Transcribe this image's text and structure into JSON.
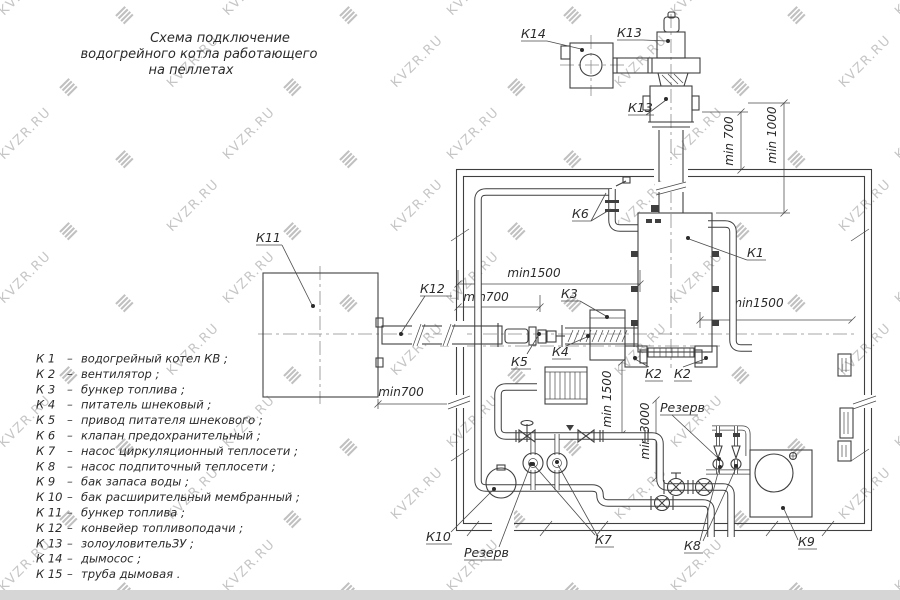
{
  "watermark": {
    "text": "KVZR.RU",
    "color": "#c6c6c6"
  },
  "title": {
    "lines": [
      "Схема подключение",
      "водогрейного котла работающего",
      "на пеллетах"
    ]
  },
  "legend": {
    "dash": "–",
    "items": [
      {
        "k": "К 1",
        "d": "водогрейный котел КВ ;"
      },
      {
        "k": "К 2",
        "d": "вентилятор ;"
      },
      {
        "k": "К 3",
        "d": "бункер топлива ;"
      },
      {
        "k": "К 4",
        "d": "питатель шнековый ;"
      },
      {
        "k": "К 5",
        "d": "привод питателя шнекового ;"
      },
      {
        "k": "К 6",
        "d": "клапан предохранительный ;"
      },
      {
        "k": "К 7",
        "d": "насос циркуляционный теплосети ;"
      },
      {
        "k": "К 8",
        "d": "насос подпиточный теплосети ;"
      },
      {
        "k": "К 9",
        "d": "бак запаса воды ;"
      },
      {
        "k": "К 10",
        "d": "бак расширительный мембранный ;"
      },
      {
        "k": "К 11",
        "d": "бункер топлива ;"
      },
      {
        "k": "К 12",
        "d": "конвейер топливоподачи ;"
      },
      {
        "k": "К 13",
        "d": "золоуловительЗУ ;"
      },
      {
        "k": "К 14",
        "d": "дымосос ;"
      },
      {
        "k": "К 15",
        "d": "труба дымовая ."
      }
    ]
  },
  "diagram": {
    "callouts": [
      {
        "id": "k14",
        "text": "К14",
        "tx": 521,
        "ty": 38,
        "ux2": 547,
        "leaders": [
          [
            547,
            41,
            581,
            49
          ]
        ],
        "dots": [
          [
            582,
            50
          ]
        ]
      },
      {
        "id": "k13-top",
        "text": "К13",
        "tx": 617,
        "ty": 37,
        "ux2": 643,
        "leaders": [
          [
            643,
            40,
            667,
            41
          ]
        ],
        "dots": [
          [
            668,
            41
          ]
        ]
      },
      {
        "id": "k13-mid",
        "text": "К13",
        "tx": 628,
        "ty": 112,
        "ux2": 654,
        "leaders": [
          [
            646,
            115,
            666,
            100
          ]
        ],
        "dots": [
          [
            666,
            99
          ]
        ]
      },
      {
        "id": "k6",
        "text": "К6",
        "tx": 572,
        "ty": 218,
        "ux2": 591,
        "leaders": [
          [
            591,
            221,
            606,
            193
          ],
          [
            591,
            221,
            611,
            209
          ]
        ],
        "dots": []
      },
      {
        "id": "k1",
        "text": "К1",
        "tx": 747,
        "ty": 257,
        "ux2": 766,
        "leaders": [
          [
            747,
            260,
            689,
            239
          ]
        ],
        "dots": [
          [
            688,
            238
          ]
        ]
      },
      {
        "id": "k11",
        "text": "К11",
        "tx": 256,
        "ty": 242,
        "ux2": 282,
        "leaders": [
          [
            282,
            245,
            312,
            305
          ]
        ],
        "dots": [
          [
            313,
            306
          ]
        ]
      },
      {
        "id": "k12",
        "text": "К12",
        "tx": 420,
        "ty": 293,
        "ux2": 452,
        "leaders": [
          [
            425,
            296,
            401,
            333
          ]
        ],
        "dots": [
          [
            401,
            334
          ]
        ]
      },
      {
        "id": "k3",
        "text": "К3",
        "tx": 561,
        "ty": 298,
        "ux2": 580,
        "leaders": [
          [
            580,
            301,
            606,
            316
          ]
        ],
        "dots": [
          [
            607,
            317
          ]
        ]
      },
      {
        "id": "k5",
        "text": "К5",
        "tx": 511,
        "ty": 366,
        "ux2": 531,
        "leaders": [
          [
            527,
            354,
            538,
            336
          ]
        ],
        "dots": [
          [
            539,
            334
          ]
        ]
      },
      {
        "id": "k4",
        "text": "К4",
        "tx": 552,
        "ty": 356,
        "ux2": 571,
        "leaders": [
          [
            566,
            346,
            587,
            337
          ]
        ],
        "dots": [
          [
            588,
            336
          ]
        ]
      },
      {
        "id": "k2-left",
        "text": "К2",
        "tx": 645,
        "ty": 378,
        "ux2": 663,
        "leaders": [
          [
            649,
            367,
            635,
            359
          ]
        ],
        "dots": [
          [
            635,
            358
          ]
        ]
      },
      {
        "id": "k2-right",
        "text": "К2",
        "tx": 674,
        "ty": 378,
        "ux2": 692,
        "leaders": [
          [
            683,
            367,
            705,
            359
          ]
        ],
        "dots": [
          [
            706,
            358
          ]
        ]
      },
      {
        "id": "rezerv-top",
        "text": "Резерв",
        "tx": 660,
        "ty": 412,
        "ux2": 698,
        "leaders": [
          [
            672,
            415,
            718,
            458
          ]
        ],
        "dots": [
          [
            719,
            459
          ]
        ]
      },
      {
        "id": "k10",
        "text": "К10",
        "tx": 426,
        "ty": 541,
        "ux2": 452,
        "leaders": [
          [
            451,
            532,
            493,
            490
          ]
        ],
        "dots": [
          [
            494,
            489
          ]
        ]
      },
      {
        "id": "rezerv-bottom",
        "text": "Резерв",
        "tx": 464,
        "ty": 557,
        "ux2": 502,
        "leaders": [
          [
            499,
            547,
            530,
            466
          ]
        ],
        "dots": [
          [
            531,
            464
          ]
        ]
      },
      {
        "id": "k7",
        "text": "К7",
        "tx": 595,
        "ty": 544,
        "ux2": 614,
        "leaders": [
          [
            595,
            535,
            534,
            465
          ],
          [
            597,
            535,
            558,
            465
          ]
        ],
        "dots": [
          [
            533,
            464
          ],
          [
            557,
            462
          ]
        ]
      },
      {
        "id": "k8",
        "text": "К8",
        "tx": 684,
        "ty": 550,
        "ux2": 703,
        "leaders": [
          [
            700,
            541,
            719,
            469
          ],
          [
            703,
            541,
            736,
            468
          ]
        ],
        "dots": [
          [
            720,
            467
          ],
          [
            736,
            466
          ]
        ]
      },
      {
        "id": "k9",
        "text": "К9",
        "tx": 798,
        "ty": 546,
        "ux2": 817,
        "leaders": [
          [
            798,
            540,
            784,
            509
          ]
        ],
        "dots": [
          [
            783,
            508
          ]
        ]
      }
    ],
    "dimensions": [
      {
        "text": "min1500",
        "tx": 534,
        "ty": 277,
        "rot": 0,
        "lines": [
          [
            458,
            270,
            458,
            300
          ],
          [
            640,
            270,
            640,
            292
          ],
          [
            458,
            284,
            640,
            284
          ]
        ],
        "ticks": [
          [
            458,
            284
          ],
          [
            640,
            284
          ]
        ]
      },
      {
        "text": "min700",
        "tx": 486,
        "ty": 301,
        "rot": 0,
        "lines": [
          [
            540,
            295,
            540,
            312
          ],
          [
            458,
            307,
            540,
            307
          ]
        ],
        "ticks": [
          [
            458,
            307
          ],
          [
            540,
            307
          ]
        ]
      },
      {
        "text": "min1500",
        "tx": 757,
        "ty": 307,
        "rot": 0,
        "lines": [
          [
            700,
            312,
            700,
            328
          ],
          [
            700,
            320,
            852,
            320
          ]
        ],
        "ticks": [
          [
            700,
            320
          ],
          [
            852,
            320
          ]
        ]
      },
      {
        "text": "min700",
        "tx": 401,
        "ty": 396,
        "rot": 0,
        "lines": [
          [
            378,
            399,
            378,
            409
          ],
          [
            378,
            404,
            457,
            404
          ]
        ],
        "ticks": [
          [
            378,
            404
          ],
          [
            457,
            404
          ]
        ]
      },
      {
        "text": "min 700",
        "tx": 733,
        "ty": 141,
        "rot": -90,
        "lines": [
          [
            702,
            112,
            748,
            112
          ],
          [
            741,
            112,
            741,
            170
          ]
        ],
        "ticks": [
          [
            741,
            112
          ],
          [
            741,
            170
          ]
        ]
      },
      {
        "text": "min 1000",
        "tx": 776,
        "ty": 135,
        "rot": -90,
        "lines": [
          [
            748,
            103,
            790,
            103
          ],
          [
            716,
            213,
            790,
            213
          ],
          [
            784,
            103,
            784,
            213
          ]
        ],
        "ticks": [
          [
            784,
            103
          ],
          [
            784,
            213
          ]
        ]
      },
      {
        "text": "min 1500",
        "tx": 611,
        "ty": 399,
        "rot": -90,
        "lines": [
          [
            622,
            362,
            622,
            434
          ]
        ],
        "ticks": [
          [
            622,
            362
          ],
          [
            622,
            434
          ]
        ]
      },
      {
        "text": "min 3000",
        "tx": 649,
        "ty": 431,
        "rot": -90,
        "lines": [
          [
            656,
            400,
            656,
            478
          ]
        ],
        "ticks": [
          [
            656,
            400
          ],
          [
            656,
            478
          ]
        ]
      }
    ]
  }
}
